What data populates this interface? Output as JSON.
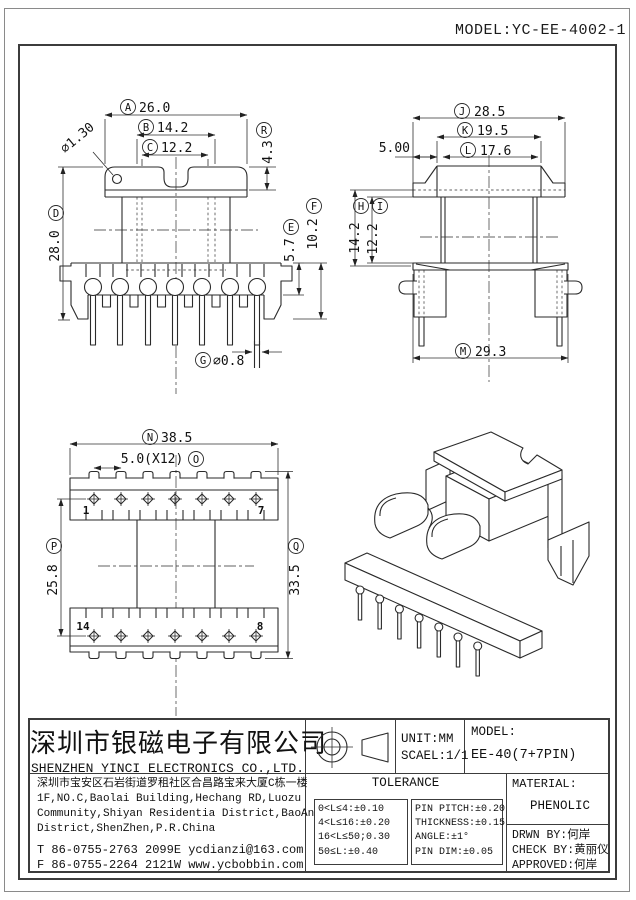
{
  "header": {
    "model": "MODEL:YC-EE-4002-1"
  },
  "front": {
    "hole": "⌀1.30",
    "dimA": {
      "letter": "A",
      "value": "26.0"
    },
    "dimB": {
      "letter": "B",
      "value": "14.2"
    },
    "dimC": {
      "letter": "C",
      "value": "12.2"
    },
    "dimR": {
      "letter": "R",
      "value": "4.3"
    },
    "dimD": {
      "letter": "D",
      "value": "28.0"
    },
    "dimE": {
      "letter": "E",
      "value": "5.7"
    },
    "dimF": {
      "letter": "F",
      "value": "10.2"
    },
    "dimG": {
      "letter": "G",
      "value": "⌀0.8"
    }
  },
  "side": {
    "dimJ": {
      "letter": "J",
      "value": "28.5"
    },
    "dimK": {
      "letter": "K",
      "value": "19.5"
    },
    "dimL": {
      "letter": "L",
      "value": "17.6"
    },
    "wing": "5.00",
    "dimH": {
      "letter": "H",
      "value": "14.2"
    },
    "dimI": {
      "letter": "I",
      "value": "12.2"
    },
    "dimM": {
      "letter": "M",
      "value": "29.3"
    }
  },
  "bottom": {
    "dimN": {
      "letter": "N",
      "value": "38.5"
    },
    "dimO": {
      "letter": "O",
      "value": "5.0(X12)"
    },
    "dimP": {
      "letter": "P",
      "value": "25.8"
    },
    "dimQ": {
      "letter": "Q",
      "value": "33.5"
    },
    "pin_first_top": "1",
    "pin_last_top": "7",
    "pin_first_bottom": "14",
    "pin_last_bottom": "8"
  },
  "titleblock": {
    "company_cn": "深圳市银磁电子有限公司",
    "company_en": "SHENZHEN YINCI ELECTRONICS CO.,LTD.",
    "address_cn": "深圳市宝安区石岩街道罗租社区合昌路宝来大厦C栋一楼",
    "address_en1": "1F,NO.C,Baolai Building,Hechang RD,Luozu",
    "address_en2": "Community,Shiyan Residentia District,BaoAn",
    "address_en3": "District,ShenZhen,P.R.China",
    "tel": "T 86-0755-2763 2099",
    "email": "E ycdianzi@163.com",
    "fax": "F 86-0755-2264 2121",
    "web": "W www.ycbobbin.com",
    "unit": "UNIT:MM",
    "scale": "SCAEL:1/1",
    "model_label": "MODEL:",
    "model_value": "EE-40(7+7PIN)",
    "tolerance_title": "TOLERANCE",
    "tol_general": [
      "0<L≤4:±0.10",
      "4<L≤16:±0.20",
      "16<L≤50;0.30",
      "50≤L:±0.40"
    ],
    "tol_specific": [
      "PIN PITCH:±0.20",
      "THICKNESS:±0.15",
      "ANGLE:±1°",
      "PIN DIM:±0.05"
    ],
    "material_label": "MATERIAL:",
    "material_value": "PHENOLIC",
    "drawn_by": "DRWN BY:何岸",
    "check_by": "CHECK BY:黄丽仪",
    "approved": "APPROVED:何岸"
  }
}
